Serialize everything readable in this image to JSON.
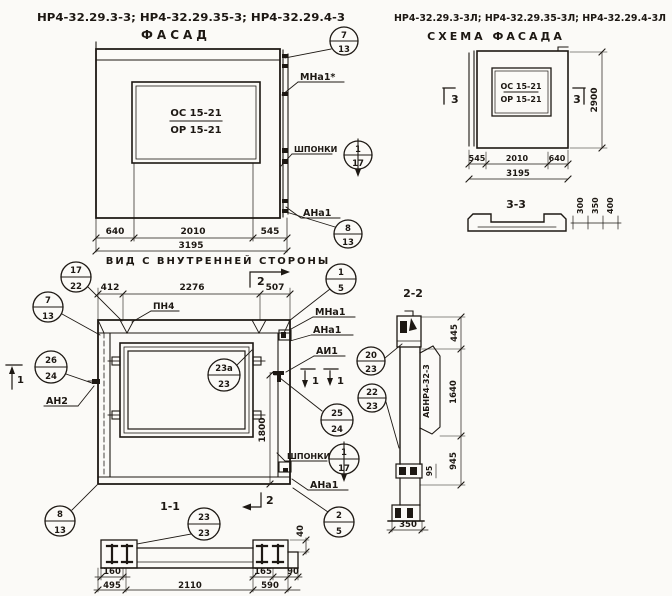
{
  "titles": {
    "left_codes": "НР4-32.29.3-3; НР4-32.29.35-3; НР4-32.29.4-3",
    "left_name": "ФАСАД",
    "right_codes": "НР4-32.29.3-3Л; НР4-32.29.35-3Л; НР4-32.29.4-3Л",
    "right_name": "СХЕМА ФАСАДА"
  },
  "facade": {
    "window_top": "ОС 15-21",
    "window_bottom": "ОР 15-21",
    "dim_left": "640",
    "dim_mid": "2010",
    "dim_right": "545",
    "dim_total": "3195",
    "caption": "ВИД С ВНУТРЕННЕЙ СТОРОНЫ",
    "label_anchor_top": "МНа1*",
    "label_keys": "ШПОНКИ",
    "label_anchor_bottom": "АНа1",
    "ref_top": {
      "num": "7",
      "den": "13"
    },
    "ref_keys": {
      "num": "1",
      "den": "17"
    },
    "ref_bottom": {
      "num": "8",
      "den": "13"
    }
  },
  "scheme": {
    "window_top": "ОС 15-21",
    "window_bottom": "ОР 15-21",
    "dim_left": "545",
    "dim_mid": "2010",
    "dim_right": "640",
    "dim_total": "3195",
    "dim_height": "2900",
    "section_mark": "3"
  },
  "section33": {
    "title": "3-3",
    "dim_a": "300",
    "dim_b": "350",
    "dim_c": "400"
  },
  "view11": {
    "title": "1-1",
    "dim_412": "412",
    "dim_2276": "2276",
    "dim_507": "507",
    "label_pn4": "ПН4",
    "label_mna1": "МНа1",
    "label_ana1_top": "АНа1",
    "label_ai1": "АИ1",
    "label_keys": "ШПОНКИ",
    "label_ana1_bottom": "АНа1",
    "label_an2": "АН2",
    "dim_1800": "1800",
    "dim_160": "160",
    "dim_495": "495",
    "dim_2110": "2110",
    "dim_165": "165",
    "dim_590": "590",
    "dim_90": "90",
    "dim_40": "40",
    "section1_mark": "1",
    "section2_mark": "2",
    "ref_17_22": {
      "num": "17",
      "den": "22"
    },
    "ref_7_13": {
      "num": "7",
      "den": "13"
    },
    "ref_1_5": {
      "num": "1",
      "den": "5"
    },
    "ref_23a_23": {
      "num": "23а",
      "den": "23"
    },
    "ref_20_23": {
      "num": "20",
      "den": "23"
    },
    "ref_22_23": {
      "num": "22",
      "den": "23"
    },
    "ref_25_24": {
      "num": "25",
      "den": "24"
    },
    "ref_keys": {
      "num": "1",
      "den": "17"
    },
    "ref_26_24": {
      "num": "26",
      "den": "24"
    },
    "ref_8_13": {
      "num": "8",
      "den": "13"
    },
    "ref_2_5": {
      "num": "2",
      "den": "5"
    },
    "ref_23_23": {
      "num": "23",
      "den": "23"
    }
  },
  "section22": {
    "title": "2-2",
    "panel_mark": "АБНР4-32-3",
    "dim_445": "445",
    "dim_1640": "1640",
    "dim_945": "945",
    "dim_95": "95",
    "dim_350": "350"
  }
}
